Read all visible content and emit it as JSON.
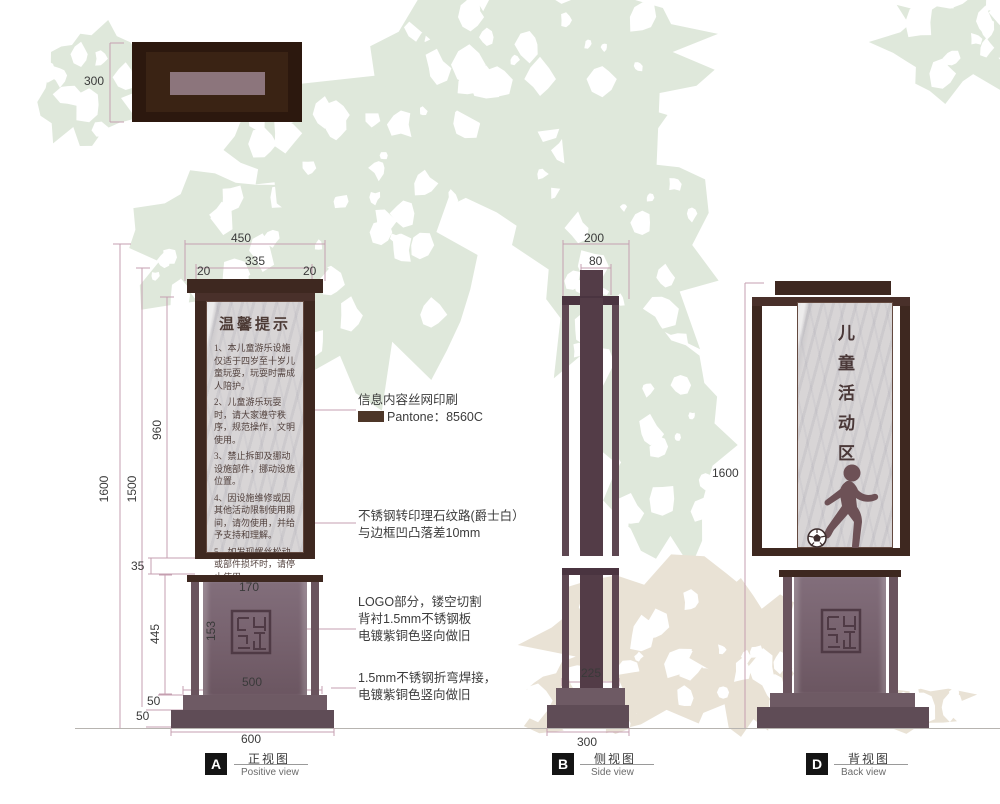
{
  "colors": {
    "frame_dark": "#3e2820",
    "base_mauve": "#76616d",
    "dim_pink": "#c59fb0",
    "foliage_green": "#dfe8db",
    "bush_beige": "#e9e2d5",
    "pantone_swatch": "#4d3628"
  },
  "top_view": {
    "dim_depth": "300"
  },
  "front_view": {
    "dims": {
      "w_total": "450",
      "w_inner": "335",
      "m_left": "20",
      "m_right": "20",
      "h_total": "1600",
      "h_body": "1500",
      "h_panel": "960",
      "gap": "35",
      "h_base": "445",
      "logo_w": "170",
      "logo_h": "153",
      "base_w": "500",
      "step1": "50",
      "step2": "50",
      "bottom_w": "600"
    },
    "panel": {
      "title": "温馨提示",
      "items": [
        "1、本儿童游乐设施仅适于四岁至十岁儿童玩耍，玩耍时需成人陪护。",
        "2、儿童游乐玩耍时，请大家遵守秩序，规范操作，文明使用。",
        "3、禁止拆卸及挪动设施部件，挪动设施位置。",
        "4、因设施维修或因其他活动限制使用期间，请勿使用，并给予支持和理解。",
        "5、如发现螺丝松动或部件损坏时，请停止使用。"
      ]
    },
    "label": {
      "letter": "A",
      "cn": "正视图",
      "en": "Positive view"
    }
  },
  "side_view": {
    "dims": {
      "d_total": "200",
      "d_post": "80",
      "d_base": "225",
      "d_bottom": "300"
    },
    "label": {
      "letter": "B",
      "cn": "侧视图",
      "en": "Side view"
    }
  },
  "back_view": {
    "dims": {
      "h_total": "1600"
    },
    "panel_text": "儿童活动区",
    "label": {
      "letter": "D",
      "cn": "背视图",
      "en": "Back view"
    }
  },
  "annotations": {
    "print": {
      "line1": "信息内容丝网印刷",
      "line2": "Pantone：8560C"
    },
    "marble": {
      "line1": "不锈钢转印理石纹路(爵士白）",
      "line2": "与边框凹凸落差10mm"
    },
    "logo": {
      "line1": "LOGO部分，镂空切割",
      "line2": "背衬1.5mm不锈钢板",
      "line3": "电镀紫铜色竖向做旧"
    },
    "weld": {
      "line1": "1.5mm不锈钢折弯焊接，",
      "line2": "电镀紫铜色竖向做旧"
    }
  }
}
